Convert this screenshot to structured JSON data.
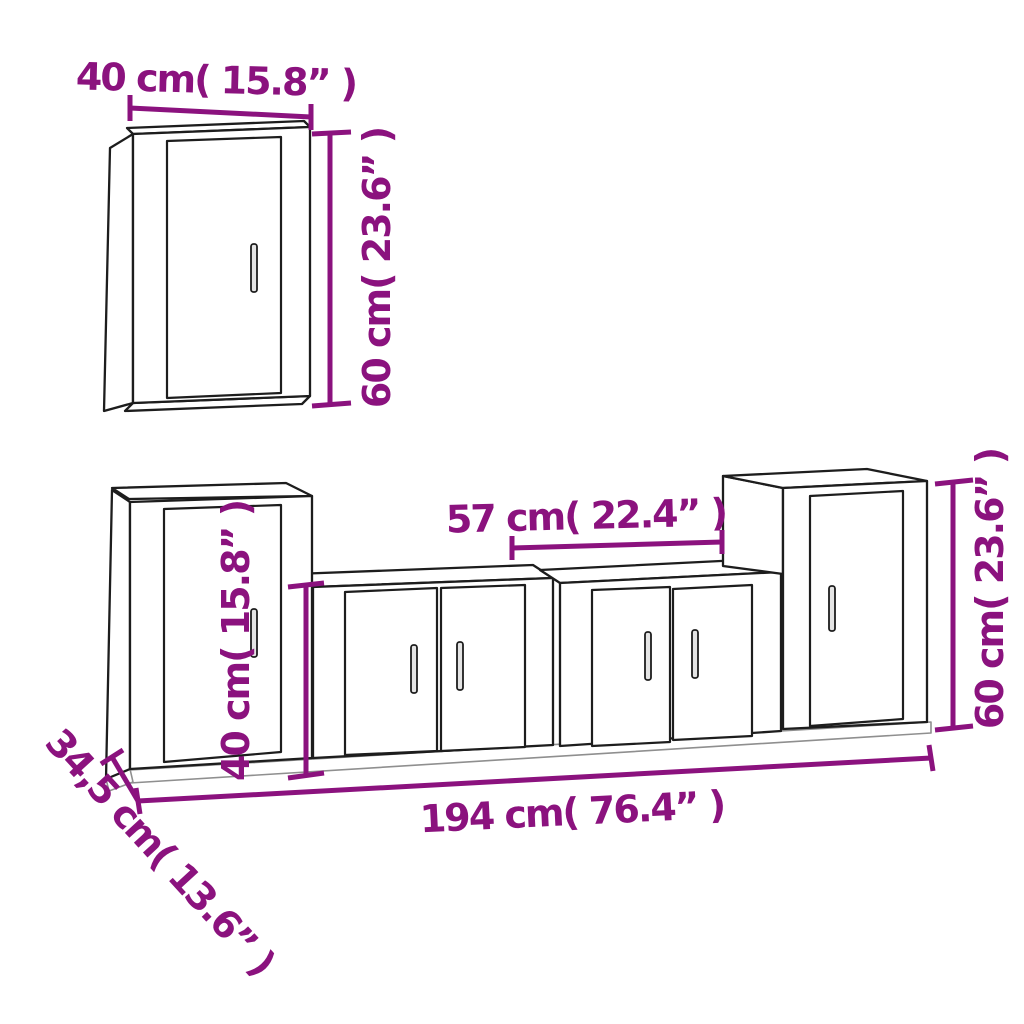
{
  "diagram": {
    "accent_color": "#8B127E",
    "outline_color": "#1d1d1d",
    "labels": {
      "wall_cabinet_width": "40 cm( 15.8” )",
      "wall_cabinet_height": "60 cm( 23.6” )",
      "left_cabinet_height": "40 cm( 15.8” )",
      "center_cabinet_width": "57 cm( 22.4” )",
      "right_cabinet_height": "60 cm( 23.6” )",
      "total_width": "194 cm( 76.4” )",
      "depth": "34,5 cm( 13.6” )"
    }
  }
}
